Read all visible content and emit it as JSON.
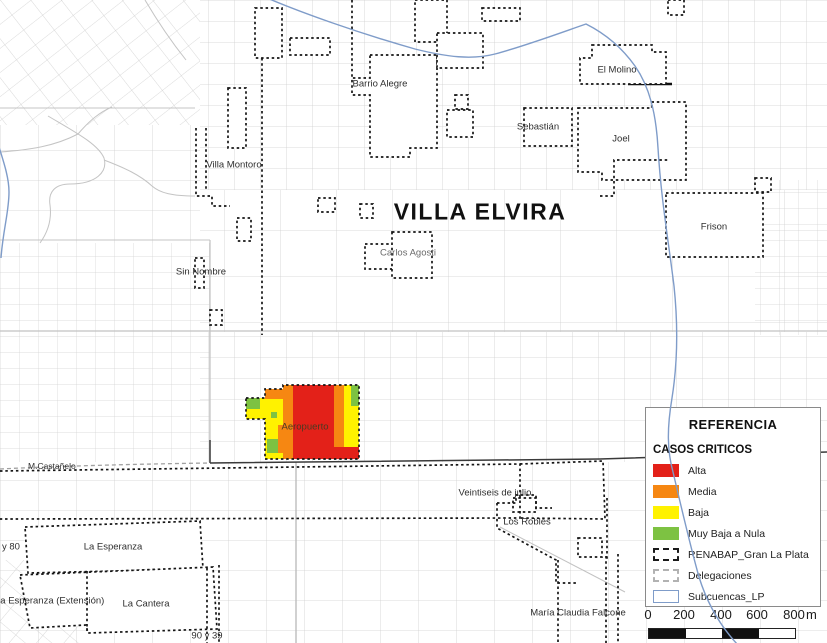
{
  "map": {
    "title": "VILLA ELVIRA",
    "labels": {
      "barrio_alegre": "Barrio Alegre",
      "el_molino": "El Molino",
      "sebastian": "Sebastián",
      "joel": "Joel",
      "villa_montoro": "Villa Montoro",
      "carlos_agosti": "Carlos Agosti",
      "sin_nombre": "Sin Nombre",
      "frison": "Frison",
      "aeropuerto": "Aeropuerto",
      "m_castanelo": "M.Castañelo",
      "veintiseis_de_julio": "Veintiseis de julio",
      "y_80": "y 80",
      "la_esperanza": "La Esperanza",
      "los_robles": "Los Robles",
      "la_esperanza_extension": "La Esperanza (Extensión)",
      "la_cantera": "La Cantera",
      "calle_90_y_39": "90 y 39",
      "maria_claudia_falcone": "María Claudia Falcone"
    },
    "colors": {
      "alta": "#E32119",
      "media": "#F68712",
      "baja": "#FFF200",
      "muy_baja_a_nula": "#7DC242",
      "renabap_outline": "#1A1A1A",
      "delegaciones_outline": "#B2B2B2",
      "subcuencas_line": "#7F9CC9",
      "street_grid": "#CCCCCC"
    }
  },
  "legend": {
    "title": "REFERENCIA",
    "subtitle": "CASOS CRITICOS",
    "items": [
      {
        "label": "Alta",
        "color": "#E32119",
        "type": "fill"
      },
      {
        "label": "Media",
        "color": "#F68712",
        "type": "fill"
      },
      {
        "label": "Baja",
        "color": "#FFF200",
        "type": "fill"
      },
      {
        "label": "Muy Baja a Nula",
        "color": "#7DC242",
        "type": "fill"
      },
      {
        "label": "RENABAP_Gran La Plata",
        "color": "#1A1A1A",
        "type": "dashed-outline"
      },
      {
        "label": "Delegaciones",
        "color": "#B2B2B2",
        "type": "dashed-outline"
      },
      {
        "label": "Subcuencas_LP",
        "color": "#7F9CC9",
        "type": "outline"
      }
    ]
  },
  "scalebar": {
    "ticks": [
      "0",
      "200",
      "400",
      "600",
      "800"
    ],
    "unit": "m"
  }
}
